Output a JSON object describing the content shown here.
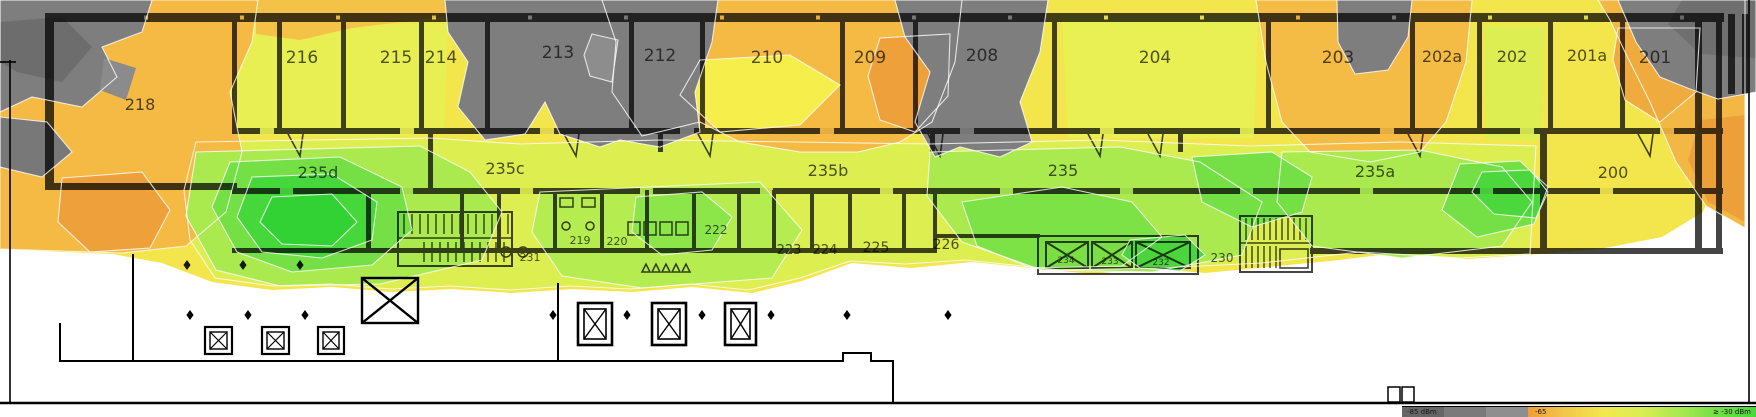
{
  "rooms": [
    {
      "id": "216",
      "x": 302,
      "y": 63,
      "fs": 17
    },
    {
      "id": "215",
      "x": 396,
      "y": 63,
      "fs": 17
    },
    {
      "id": "214",
      "x": 441,
      "y": 63,
      "fs": 17
    },
    {
      "id": "213",
      "x": 558,
      "y": 58,
      "fs": 17
    },
    {
      "id": "212",
      "x": 660,
      "y": 61,
      "fs": 17
    },
    {
      "id": "210",
      "x": 767,
      "y": 63,
      "fs": 17
    },
    {
      "id": "209",
      "x": 870,
      "y": 63,
      "fs": 17
    },
    {
      "id": "208",
      "x": 982,
      "y": 61,
      "fs": 17
    },
    {
      "id": "204",
      "x": 1155,
      "y": 63,
      "fs": 17
    },
    {
      "id": "203",
      "x": 1338,
      "y": 63,
      "fs": 17
    },
    {
      "id": "202a",
      "x": 1442,
      "y": 62,
      "fs": 16
    },
    {
      "id": "202",
      "x": 1512,
      "y": 62,
      "fs": 16
    },
    {
      "id": "201a",
      "x": 1587,
      "y": 61,
      "fs": 16
    },
    {
      "id": "201",
      "x": 1655,
      "y": 63,
      "fs": 17
    },
    {
      "id": "218",
      "x": 140,
      "y": 110,
      "fs": 16
    },
    {
      "id": "235d",
      "x": 318,
      "y": 178,
      "fs": 16
    },
    {
      "id": "235c",
      "x": 505,
      "y": 174,
      "fs": 16
    },
    {
      "id": "235b",
      "x": 828,
      "y": 176,
      "fs": 16
    },
    {
      "id": "235",
      "x": 1063,
      "y": 176,
      "fs": 16
    },
    {
      "id": "235a",
      "x": 1375,
      "y": 177,
      "fs": 16
    },
    {
      "id": "200",
      "x": 1613,
      "y": 178,
      "fs": 16
    },
    {
      "id": "231",
      "x": 530,
      "y": 261,
      "fs": 11
    },
    {
      "id": "219",
      "x": 580,
      "y": 244,
      "fs": 11
    },
    {
      "id": "220",
      "x": 617,
      "y": 245,
      "fs": 11
    },
    {
      "id": "222",
      "x": 716,
      "y": 234,
      "fs": 12
    },
    {
      "id": "223",
      "x": 789,
      "y": 254,
      "fs": 13
    },
    {
      "id": "224",
      "x": 825,
      "y": 254,
      "fs": 13
    },
    {
      "id": "225",
      "x": 876,
      "y": 252,
      "fs": 14
    },
    {
      "id": "226",
      "x": 946,
      "y": 249,
      "fs": 14
    },
    {
      "id": "230",
      "x": 1222,
      "y": 262,
      "fs": 12
    },
    {
      "id": "234",
      "x": 1066,
      "y": 263,
      "fs": 9
    },
    {
      "id": "233",
      "x": 1110,
      "y": 264,
      "fs": 9
    },
    {
      "id": "232",
      "x": 1161,
      "y": 265,
      "fs": 9
    }
  ],
  "legend": {
    "min_label": "-85 dBm",
    "mid_label": "-65",
    "max_label": "≥ -30 dBm",
    "gray_steps": [
      "#666666",
      "#7a7a7a",
      "#8e8e8e"
    ],
    "gradient": [
      "#ee9e3a",
      "#f3c84a",
      "#f1e84e",
      "#d9ed51",
      "#a8e94f",
      "#72e046",
      "#47d83c"
    ]
  },
  "palette": {
    "no_signal_gray": "#7e7e7e",
    "weak_orange": "#f4ba44",
    "medium_yellow": "#f2e64c",
    "good_light_green": "#aaea4f",
    "strong_green": "#46d73b"
  },
  "survey_points": {
    "upper": [
      [
        187,
        265
      ],
      [
        243,
        265
      ],
      [
        300,
        265
      ]
    ],
    "lower": [
      [
        190,
        315
      ],
      [
        248,
        315
      ],
      [
        305,
        315
      ],
      [
        553,
        315
      ],
      [
        627,
        315
      ],
      [
        702,
        315
      ],
      [
        771,
        315
      ],
      [
        847,
        315
      ],
      [
        948,
        315
      ]
    ]
  }
}
